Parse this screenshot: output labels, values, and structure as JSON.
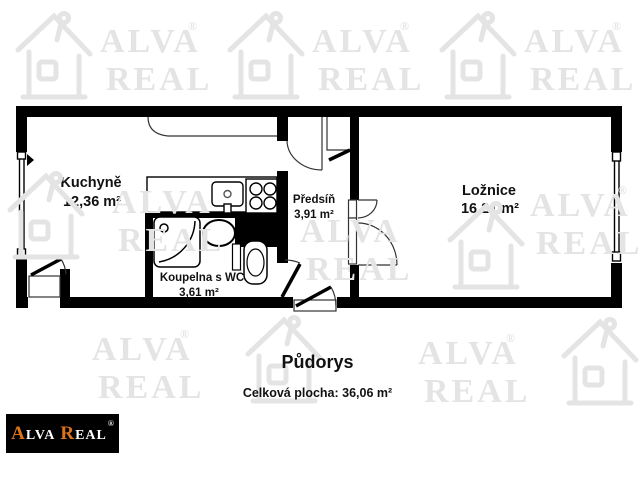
{
  "plan": {
    "title": "Půdorys",
    "total_area": "Celková plocha: 36,06 m²",
    "rooms": [
      {
        "name": "Kuchyně",
        "area": "12,36 m²"
      },
      {
        "name": "Ložnice",
        "area": "16,21 m²"
      },
      {
        "name": "Předsíň",
        "area": "3,91 m²"
      },
      {
        "name": "Koupelna s WC",
        "area": "3,61 m²"
      }
    ]
  },
  "logo": {
    "part1_accent": "A",
    "part1_rest": "LVA",
    "part2_accent": "R",
    "part2_rest": "EAL",
    "registered": "®",
    "bg_color": "#000000",
    "accent_color": "#d9731c",
    "text_color": "#ffffff"
  },
  "watermark": {
    "line1": "ALVA",
    "line2": "REAL",
    "registered": "®",
    "color": "#e4e4e4"
  },
  "colors": {
    "walls": "#000000",
    "background": "#ffffff",
    "label_text": "#111111"
  }
}
